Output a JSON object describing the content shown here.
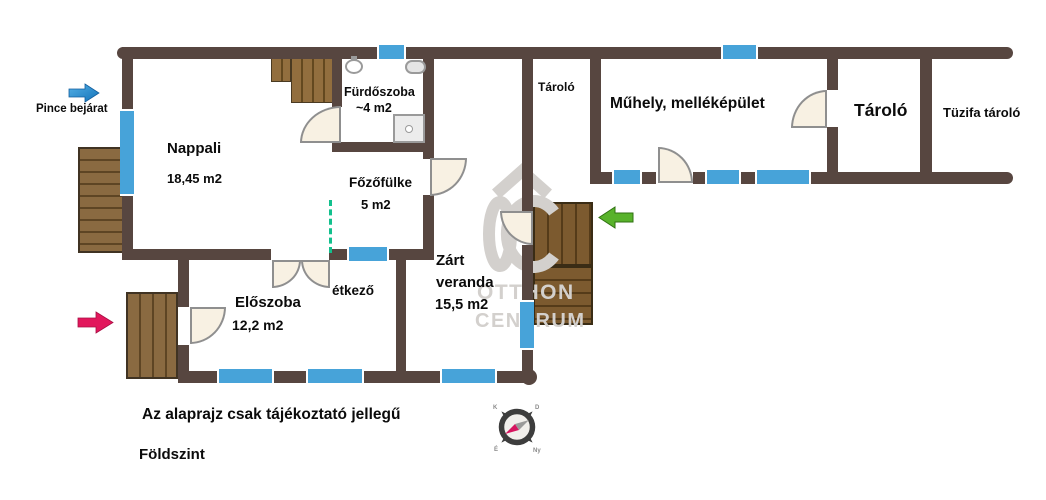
{
  "colors": {
    "wall": "#574640",
    "window_blue": "#47a3d9",
    "door_fill": "#f8f1e3",
    "wood_light": "#8a6a41",
    "wood_dark": "#7c5a2f",
    "accent_red": "#e2175c",
    "accent_green": "#58b22b",
    "accent_blue": "#2b98dd",
    "open_boundary_green": "#12c08d",
    "watermark_gray": "#d3d0cd"
  },
  "annotations": {
    "pince_bejarat": "Pince bejárat",
    "disclaimer": "Az alaprajz csak tájékoztató jellegű",
    "floor": "Földszint"
  },
  "rooms": {
    "nappali": {
      "name": "Nappali",
      "area": "18,45 m2"
    },
    "furdoszoba": {
      "name": "Fürdőszoba",
      "area": "~4 m2"
    },
    "fozofulke": {
      "name": "Főzőfülke",
      "area": "5 m2"
    },
    "eloszoba": {
      "name": "Előszoba",
      "area": "12,2 m2"
    },
    "etkezo": {
      "name": "étkező"
    },
    "zart_veranda": {
      "name_line1": "Zárt",
      "name_line2": "veranda",
      "area": "15,5 m2"
    },
    "tarolo_kis": {
      "name": "Tároló"
    },
    "muhely": {
      "name": "Műhely, melléképület"
    },
    "tarolo_nagy": {
      "name": "Tároló"
    },
    "tuzifa_tarolo": {
      "name": "Tüzifa tároló"
    }
  },
  "watermark": {
    "monogram": "OC",
    "line1": "OTTHON",
    "line2": "CENTRUM"
  },
  "compass": {
    "north": "É",
    "east": "K",
    "south": "D",
    "west": "Ny"
  }
}
